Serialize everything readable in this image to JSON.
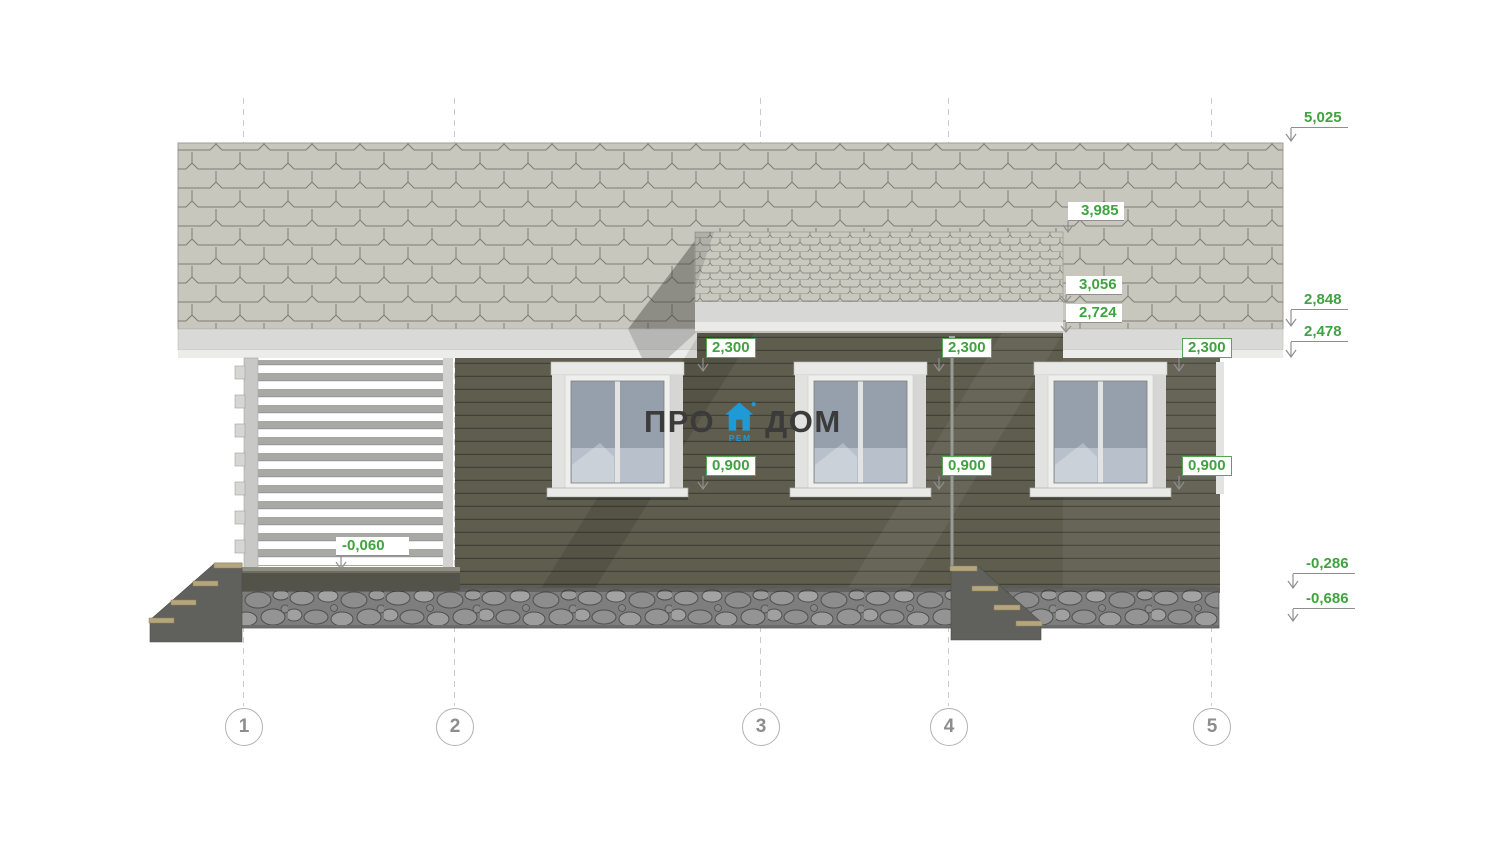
{
  "page": {
    "background": "#ffffff"
  },
  "logo": {
    "text_left": "ПРО",
    "text_right": "ДОМ",
    "icon": "house-icon",
    "icon_sub": "РЕМ",
    "text_color": "#3b3b3b",
    "accent_color": "#1f9ad6"
  },
  "axes": {
    "items": [
      {
        "label": "1"
      },
      {
        "label": "2"
      },
      {
        "label": "3"
      },
      {
        "label": "4"
      },
      {
        "label": "5"
      }
    ]
  },
  "dimensions": {
    "color": "#3fa33f",
    "right_column": [
      {
        "label": "5,025"
      },
      {
        "label": "2,848"
      },
      {
        "label": "2,478"
      },
      {
        "label": "-0,286"
      },
      {
        "label": "-0,686"
      }
    ],
    "roof_levels": [
      {
        "label": "3,985"
      },
      {
        "label": "3,056"
      },
      {
        "label": "2,724"
      }
    ],
    "window_head": {
      "label": "2,300"
    },
    "window_sill": {
      "label": "0,900"
    },
    "porch_floor": {
      "label": "-0,060"
    }
  },
  "drawing": {
    "kind": "house front elevation (facade) with shingle roof, three windows, log porch and stone foundation",
    "colors": {
      "roof_shingles": "#c7c7be",
      "fascia": "#d9d9d7",
      "wall_siding": "#5e5d4e",
      "foundation_stone": "#8a8a8a",
      "window_glass": "#96a0ad",
      "stair_tread": "#b5a67e",
      "dimension_green": "#3fa33f",
      "axis_gray": "#8d8d8d"
    }
  }
}
